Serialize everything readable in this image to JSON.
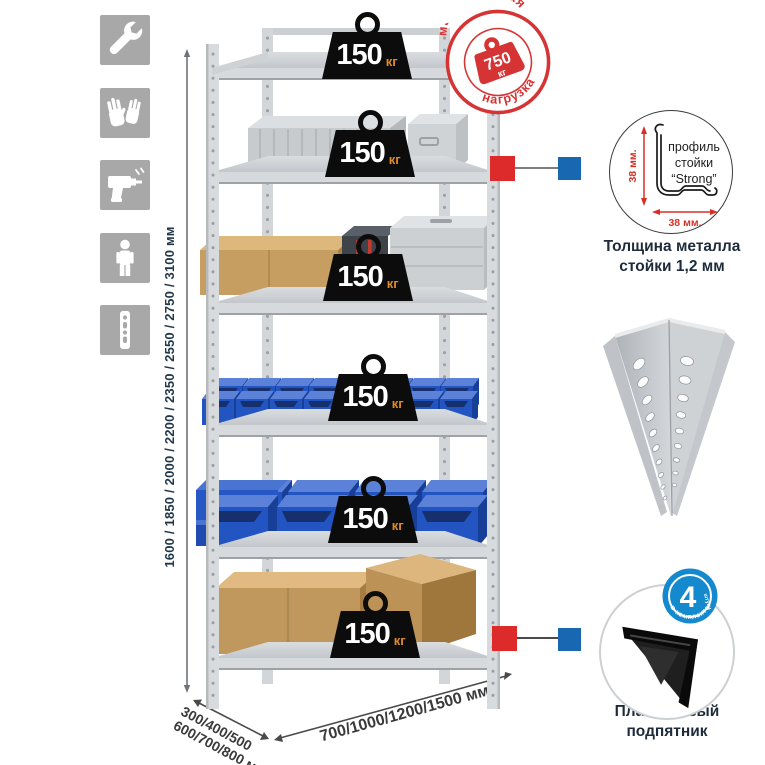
{
  "canvas": {
    "bg": "#ffffff"
  },
  "left_icons": {
    "items": [
      {
        "icon": "wrench"
      },
      {
        "icon": "gloves"
      },
      {
        "icon": "drill"
      },
      {
        "icon": "person"
      },
      {
        "icon": "rack-post"
      }
    ]
  },
  "height_dim": {
    "label": "1600 / 1850 / 2000 / 2200 / 2350 / 2550 / 2750 / 3100 мм"
  },
  "rack": {
    "load_badges": [
      {
        "value": "150",
        "unit": "кг"
      },
      {
        "value": "150",
        "unit": "кг"
      },
      {
        "value": "150",
        "unit": "кг"
      },
      {
        "value": "150",
        "unit": "кг"
      },
      {
        "value": "150",
        "unit": "кг"
      },
      {
        "value": "150",
        "unit": "кг"
      }
    ]
  },
  "stamp": {
    "arc_top": "максимальная",
    "arc_bottom": "нагрузка",
    "weight_value": "750",
    "weight_unit": "кг"
  },
  "profile_detail": {
    "dim_vertical": "38 мм.",
    "dim_horizontal": "38 мм.",
    "line1": "профиль",
    "line2": "стойки",
    "line3": "“Strong”",
    "caption_line1": "Толщина металла",
    "caption_line2": "стойки 1,2 мм"
  },
  "foot_detail": {
    "count": "4",
    "count_unit": "штуки",
    "arc_text": "в комплекте",
    "caption_line1": "Пластиковый",
    "caption_line2": "подпятник"
  },
  "depth_dim": {
    "line1": "300/400/500",
    "line2": "600/700/800 мм"
  },
  "width_dim": {
    "label": "700/1000/1200/1500 мм"
  },
  "colors": {
    "stamp_red": "#d63434",
    "marker_red": "#dd2a2a",
    "marker_blue": "#1768b0",
    "count_badge_blue": "#1489cd",
    "bin_blue": "#2254c2",
    "unit_orange": "#e08b28",
    "text_navy": "#22384a"
  }
}
